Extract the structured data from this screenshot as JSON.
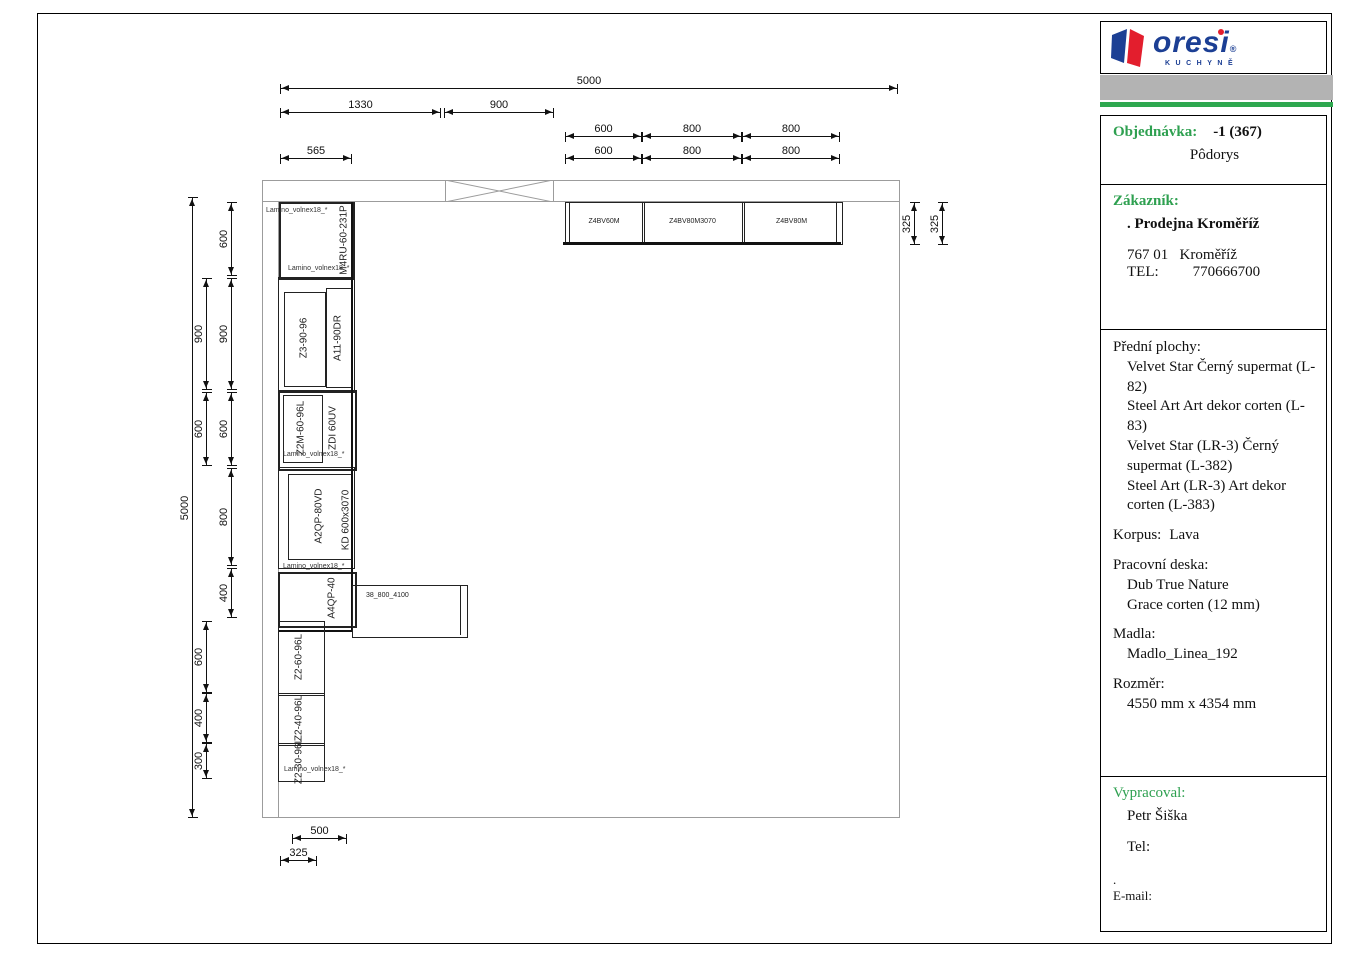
{
  "logo": {
    "brand": "oresi",
    "reg": "®",
    "sub": "KUCHYNĚ"
  },
  "panel": {
    "order": {
      "label": "Objednávka:",
      "value": "-1 (367)",
      "subtitle": "Pôdorys"
    },
    "customer": {
      "label": "Zákazník:",
      "name": ". Prodejna Kroměříž",
      "zip_city": "767 01   Kroměříž",
      "tel_label": "TEL:",
      "tel": "770666700"
    },
    "materials": {
      "fronts_label": "Přední plochy:",
      "fronts": [
        "Velvet Star Černý supermat (L-82)",
        "Steel Art Art dekor corten (L-83)",
        "Velvet Star  (LR-3) Černý supermat (L-382)",
        "Steel Art  (LR-3) Art dekor corten (L-383)"
      ],
      "korpus_label": "Korpus:",
      "korpus": "Lava",
      "worktop_label": "Pracovní deska:",
      "worktop": [
        "Dub True Nature",
        "Grace corten (12 mm)"
      ],
      "handles_label": "Madla:",
      "handles": "Madlo_Linea_192",
      "size_label": "Rozměr:",
      "size": "4550 mm x 4354 mm"
    },
    "author": {
      "label": "Vypracoval:",
      "name": "Petr Šiška",
      "tel_label": "Tel:",
      "dot": ".",
      "email_label": "E-mail:"
    }
  },
  "drawing": {
    "dims": {
      "d5000": "5000",
      "d1330": "1330",
      "d900": "900",
      "d800": "800",
      "d600": "600",
      "d565": "565",
      "d500": "500",
      "d400": "400",
      "d325": "325",
      "d300": "300"
    },
    "labels": {
      "lamino": "Lamino_volnex18_*",
      "tall_unit": "M4RU-60-231P",
      "z3": "Z3-90-96",
      "a11": "A11-90DR",
      "z2m": "Z2M-60-96L",
      "zdi": "ZDI 60UV",
      "kd": "KD 600x3070",
      "a2qp": "A2QP-80VD",
      "a4qp": "A4QP-40",
      "z260": "Z2-60-96L",
      "z240": "Z2-40-96L",
      "z230": "Z2-30-96L",
      "island": "38_800_4100",
      "wall_600": "Z4BV60M",
      "wall_800a": "Z4BV80M3070",
      "wall_800b": "Z4BV80M"
    }
  }
}
